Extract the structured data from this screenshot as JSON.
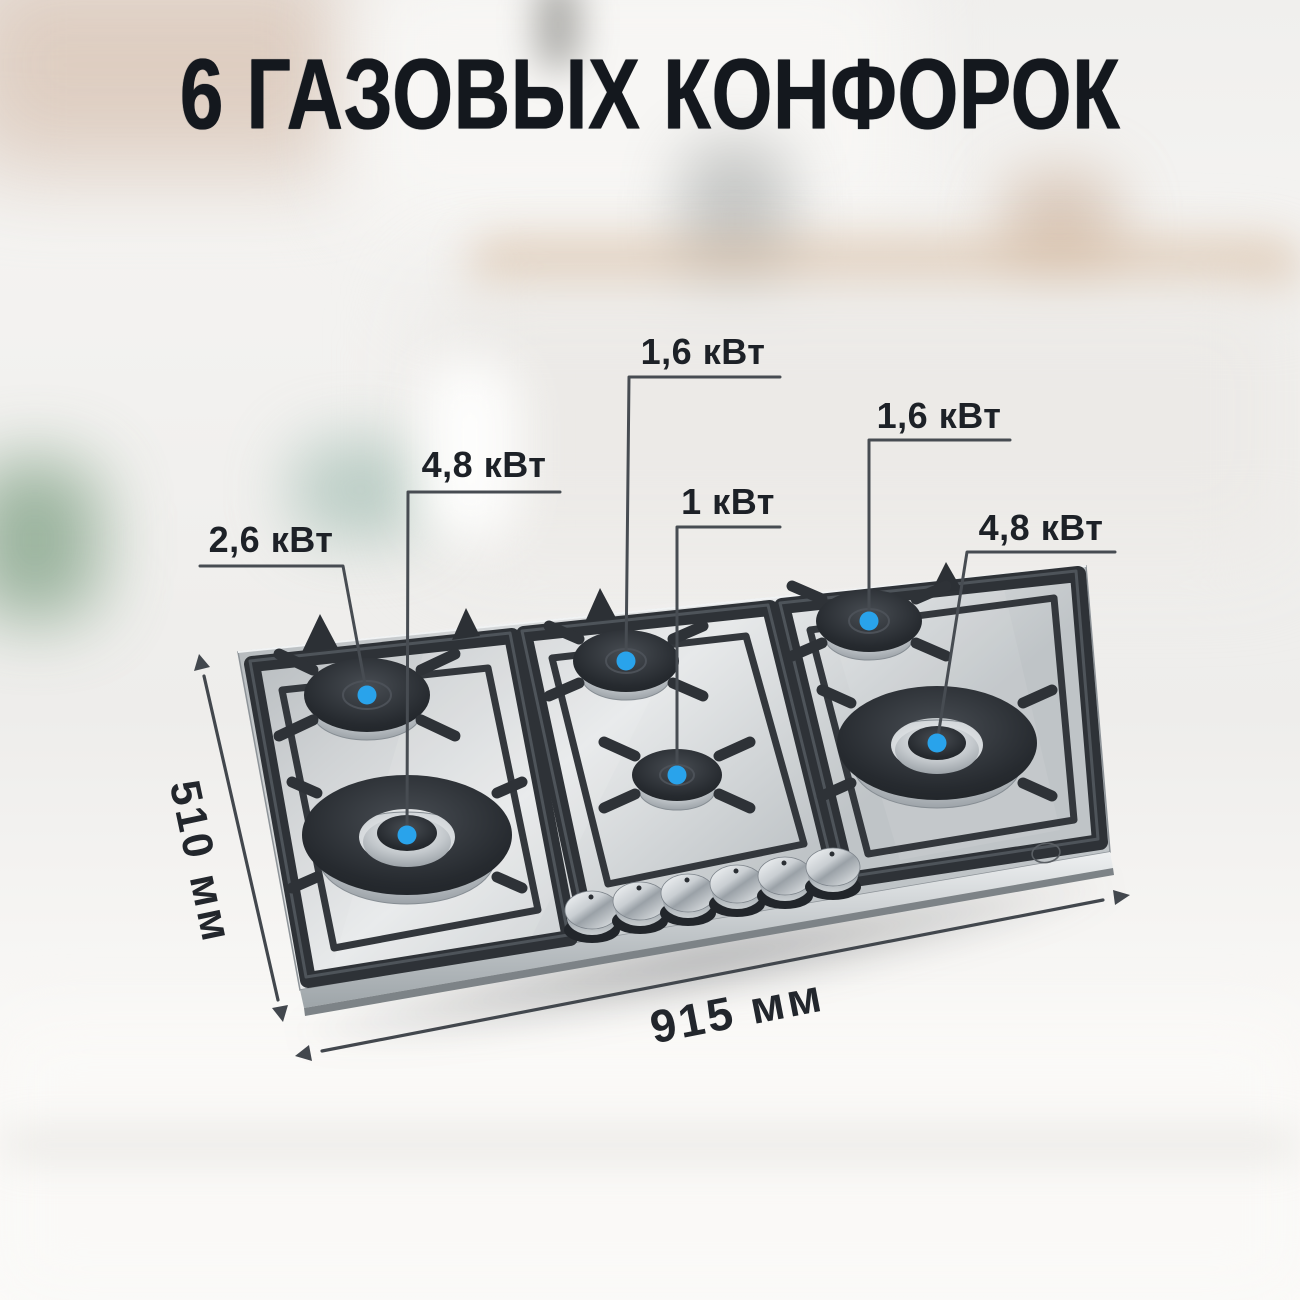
{
  "title": "6 ГАЗОВЫХ КОНФОРОК",
  "burners": [
    {
      "position": "left-back",
      "power": "2,6 кВт"
    },
    {
      "position": "left-front-wok",
      "power": "4,8 кВт"
    },
    {
      "position": "center-back",
      "power": "1,6 кВт"
    },
    {
      "position": "center-front",
      "power": "1 кВт"
    },
    {
      "position": "right-back",
      "power": "1,6 кВт"
    },
    {
      "position": "right-front-wok",
      "power": "4,8 кВт"
    }
  ],
  "dimensions": {
    "width": "915 мм",
    "depth": "510 мм"
  },
  "knob_count": 6,
  "icons": {
    "burner_marker": "●",
    "brand_logo": "◯",
    "dimension_arrow": "↔"
  },
  "colors": {
    "accent_blue": "#29A3EB",
    "title_text": "#14181E",
    "label_text": "#1D2127",
    "callout_line": "#474C52",
    "steel": "#C9CCCE",
    "grate": "#2E3237",
    "background": "#F2F1EF"
  }
}
